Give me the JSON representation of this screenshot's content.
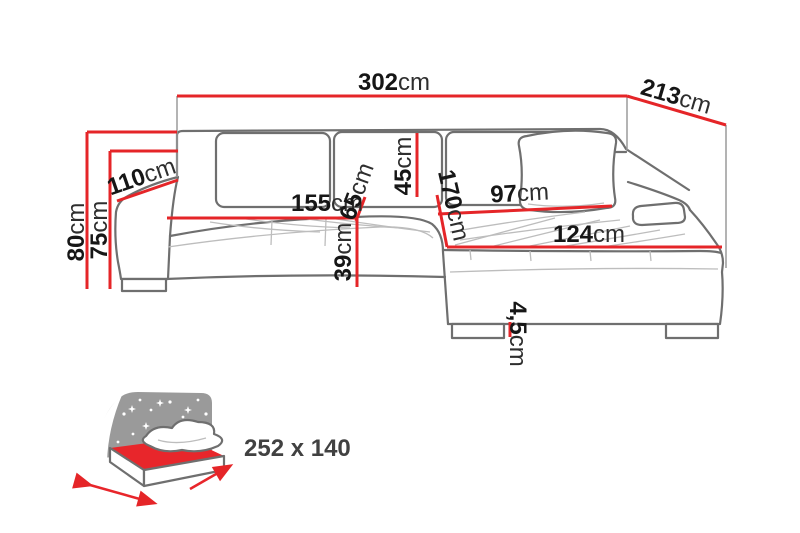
{
  "diagram": {
    "title": "corner-sofa-dimension-diagram",
    "colors": {
      "dimension_red": "#e52528",
      "outline_gray": "#6f6f6f",
      "tuft_gray": "#bdbdbd",
      "headboard_gray": "#9a9a9a",
      "label_dark": "#161616",
      "bed_label_gray": "#414141"
    },
    "dims": {
      "total_width": {
        "value": "302",
        "unit": "cm"
      },
      "total_depth": {
        "value": "213",
        "unit": "cm"
      },
      "height": {
        "value": "80",
        "unit": "cm"
      },
      "armrest_height": {
        "value": "75",
        "unit": "cm"
      },
      "arm_depth": {
        "value": "110",
        "unit": "cm"
      },
      "seat_width": {
        "value": "155",
        "unit": "cm"
      },
      "seat_depth": {
        "value": "65",
        "unit": "cm"
      },
      "backrest_height": {
        "value": "45",
        "unit": "cm"
      },
      "seat_height": {
        "value": "39",
        "unit": "cm"
      },
      "chaise_length": {
        "value": "170",
        "unit": "cm"
      },
      "chaise_width": {
        "value": "97",
        "unit": "cm"
      },
      "chaise_front_width": {
        "value": "124",
        "unit": "cm"
      },
      "leg_height": {
        "value": "4,5",
        "unit": "cm"
      }
    },
    "sleeping": {
      "label": "252 x 140"
    }
  }
}
